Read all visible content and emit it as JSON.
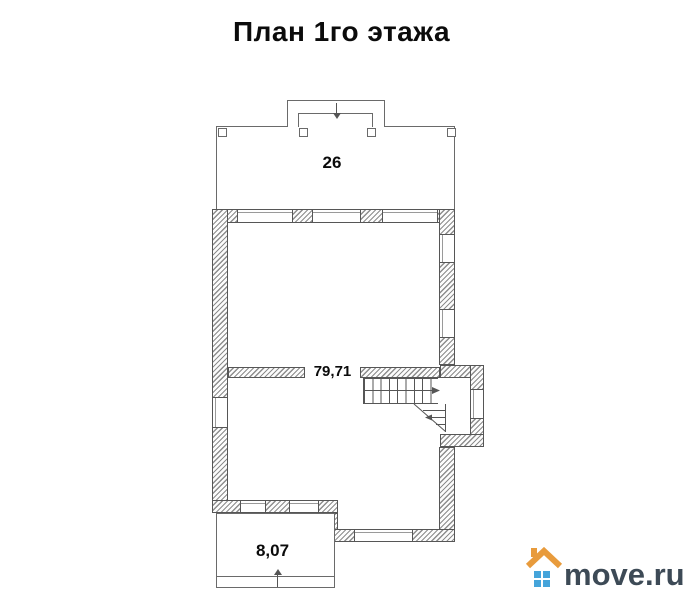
{
  "title": "План 1го этажа",
  "floor_plan": {
    "areas": [
      {
        "name": "top-terrace",
        "area_label": "26"
      },
      {
        "name": "main-floor",
        "area_label": "79,71"
      },
      {
        "name": "bottom-porch",
        "area_label": "8,07"
      }
    ],
    "icons": {
      "entry_arrow": "arrow-down-icon",
      "porch_arrow": "arrow-up-icon",
      "stairs_up_arrow": "arrow-right-icon",
      "stairs_turn_arrow": "arrow-left-icon"
    },
    "line_color": "#565656"
  },
  "watermark": {
    "text": "move.ru",
    "icon": "house-icon",
    "colors": {
      "roof": "#e89b3c",
      "window": "#45a4da",
      "text": "#3d4a56"
    }
  }
}
